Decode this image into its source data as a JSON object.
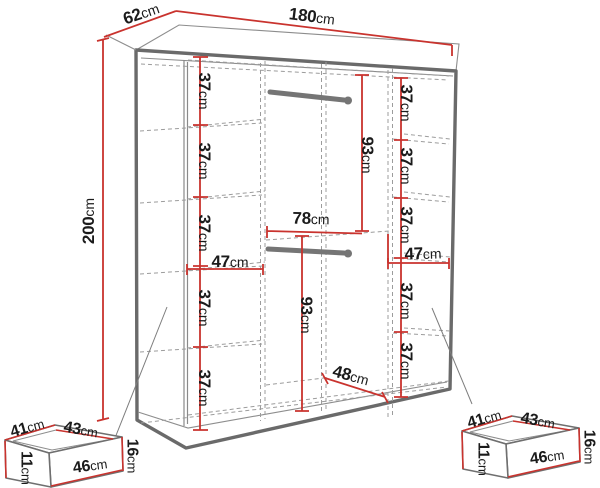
{
  "figure": {
    "kind": "wardrobe-dimension-diagram",
    "accent_color": "#c9332e",
    "line_color": "#6a6a6a"
  },
  "wardrobe": {
    "width": {
      "num": "180",
      "unit": "cm"
    },
    "depth": {
      "num": "62",
      "unit": "cm"
    },
    "height": {
      "num": "200",
      "unit": "cm"
    },
    "left_column": {
      "width": {
        "num": "47",
        "unit": "cm"
      },
      "gaps": [
        {
          "num": "37",
          "unit": "cm"
        },
        {
          "num": "37",
          "unit": "cm"
        },
        {
          "num": "37",
          "unit": "cm"
        },
        {
          "num": "37",
          "unit": "cm"
        },
        {
          "num": "37",
          "unit": "cm"
        }
      ]
    },
    "middle": {
      "upper_hanging_height": {
        "num": "93",
        "unit": "cm"
      },
      "width": {
        "num": "78",
        "unit": "cm"
      },
      "lower_hanging_height": {
        "num": "93",
        "unit": "cm"
      },
      "bottom_width": {
        "num": "48",
        "unit": "cm"
      }
    },
    "right_column": {
      "width": {
        "num": "47",
        "unit": "cm"
      },
      "gaps": [
        {
          "num": "37",
          "unit": "cm"
        },
        {
          "num": "37",
          "unit": "cm"
        },
        {
          "num": "37",
          "unit": "cm"
        },
        {
          "num": "37",
          "unit": "cm"
        },
        {
          "num": "37",
          "unit": "cm"
        }
      ]
    }
  },
  "drawer_left": {
    "top_edge": {
      "num": "41",
      "unit": "cm"
    },
    "side_edge": {
      "num": "43",
      "unit": "cm"
    },
    "front_width": {
      "num": "46",
      "unit": "cm"
    },
    "front_height": {
      "num": "16",
      "unit": "cm"
    },
    "inner_height": {
      "num": "11",
      "unit": "cm"
    }
  },
  "drawer_right": {
    "top_edge": {
      "num": "41",
      "unit": "cm"
    },
    "side_edge": {
      "num": "43",
      "unit": "cm"
    },
    "front_width": {
      "num": "46",
      "unit": "cm"
    },
    "front_height": {
      "num": "16",
      "unit": "cm"
    },
    "inner_height": {
      "num": "11",
      "unit": "cm"
    }
  }
}
